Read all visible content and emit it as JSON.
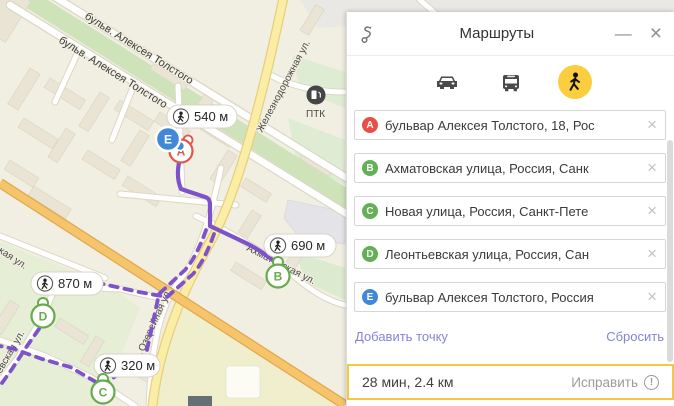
{
  "map": {
    "labels": {
      "blvd1": "бульв. Алексея Толстого",
      "blvd2": "бульв. Алексея Толстого",
      "railway_st": "Железнодорожная ул.",
      "akhmatovskaya": "Ахматовская ул.",
      "ozereynaya": "Озерейная ул.",
      "frag_kaya": "кая ул.",
      "frag_evskaya": "евская ул.",
      "gas_station": "ПТК"
    },
    "badges": [
      {
        "distance": "540 м"
      },
      {
        "distance": "690 м"
      },
      {
        "distance": "870 м"
      },
      {
        "distance": "320 м"
      }
    ],
    "markers": {
      "a": "A",
      "b": "B",
      "c": "C",
      "d": "D",
      "e": "E"
    },
    "colors": {
      "route": "#7e52c9",
      "marker_green": "#67ab4b",
      "marker_red": "#e2564b",
      "marker_blue": "#4189d8",
      "road_yellow": "#faeda6",
      "road_orange": "#f6c46a"
    }
  },
  "panel": {
    "title": "Маршруты",
    "window_controls": {
      "minimize": "—",
      "close": "×"
    },
    "modes": [
      "car",
      "bus",
      "pedestrian"
    ],
    "active_mode": "pedestrian",
    "waypoints": [
      {
        "letter": "A",
        "address": "бульвар Алексея Толстого, 18, Рос"
      },
      {
        "letter": "B",
        "address": "Ахматовская улица, Россия, Санк"
      },
      {
        "letter": "C",
        "address": "Новая улица, Россия, Санкт-Пете"
      },
      {
        "letter": "D",
        "address": "Леонтьевская улица, Россия, Сан"
      },
      {
        "letter": "E",
        "address": "бульвар Алексея Толстого, Россия"
      }
    ],
    "clear_icon": "×",
    "add_point": "Добавить точку",
    "reset": "Сбросить",
    "summary": "28 мин, 2.4 км",
    "fix": "Исправить",
    "warning_icon": "!",
    "accent_yellow": "#f3ca3d",
    "link_color": "#8583d7"
  }
}
